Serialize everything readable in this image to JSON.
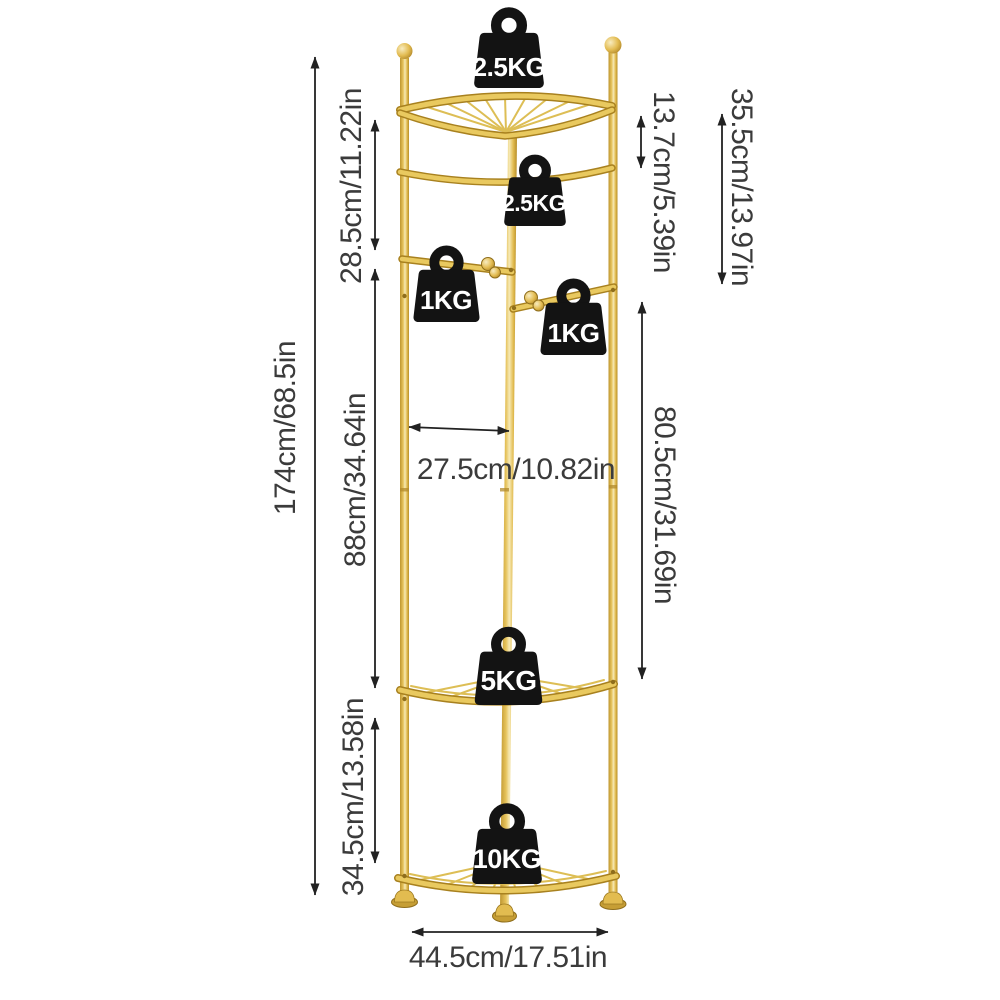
{
  "diagram": {
    "kind": "product-dimension-diagram",
    "subject": "gold corner shelf rack with coat hooks and load-capacity weights"
  },
  "weights": {
    "top_shelf": "2.5KG",
    "hanging_rail": "2.5KG",
    "left_hook": "1KG",
    "right_hook": "1KG",
    "middle_shelf": "5KG",
    "bottom_shelf": "10KG"
  },
  "dimensions": {
    "overall_height": "174cm/68.5in",
    "top_section": "28.5cm/11.22in",
    "middle_section": "88cm/34.64in",
    "bottom_section": "34.5cm/13.58in",
    "top_shelf_to_rail": "13.7cm/5.39in",
    "top_shelf_to_hooks": "35.5cm/13.97in",
    "hooks_to_middle_shelf": "80.5cm/31.69in",
    "inner_width": "27.5cm/10.82in",
    "base_width": "44.5cm/17.51in"
  },
  "colors": {
    "gold": "#E4BE54",
    "gold_dark": "#A8811F",
    "gold_light": "#F6E9B5",
    "weight_black": "#131313",
    "dimension_text": "#3B3B3B",
    "weight_text": "#FFFFFF",
    "background": "#FFFFFF"
  }
}
